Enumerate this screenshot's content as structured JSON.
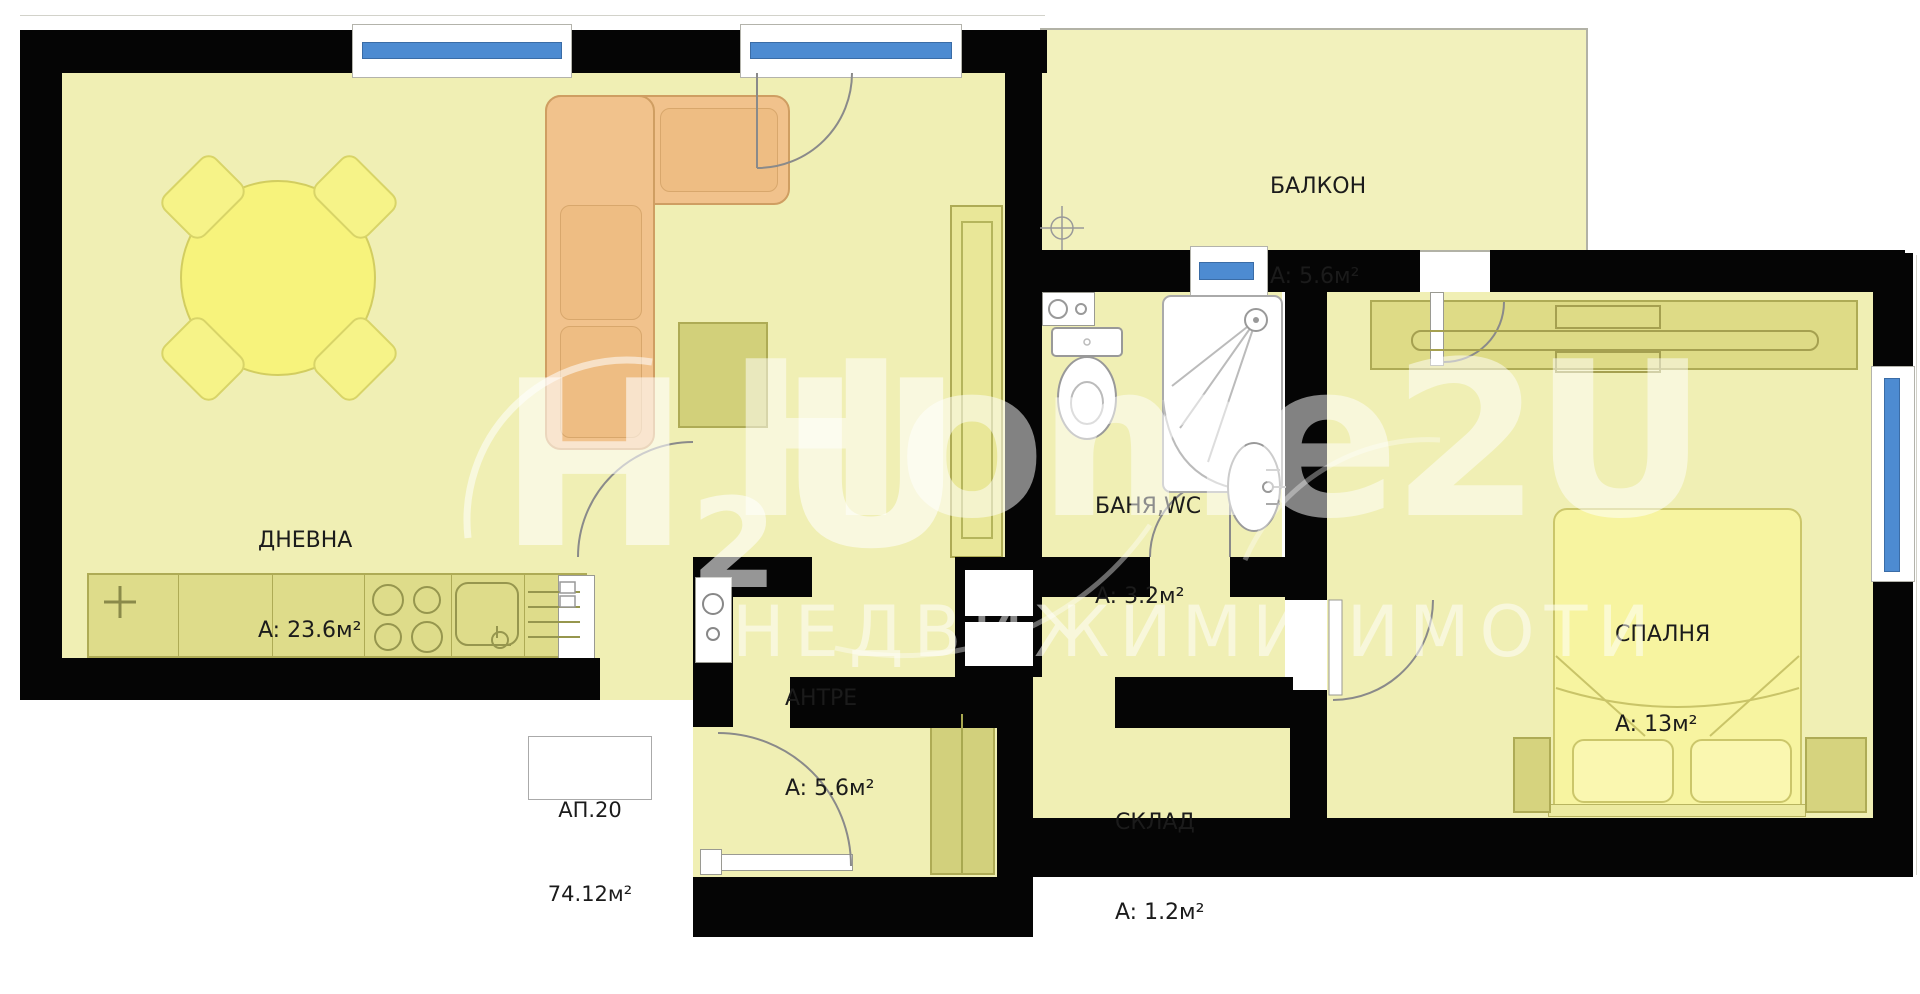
{
  "apartment": {
    "number": "АП.20",
    "total_area": "74.12м²"
  },
  "rooms": [
    {
      "name": "ДНЕВНА",
      "area": "A: 23.6м²"
    },
    {
      "name": "БАЛКОН",
      "area": "A: 5.6м²"
    },
    {
      "name": "БАНЯ,WC",
      "area": "A: 3.2м²"
    },
    {
      "name": "АНТРЕ",
      "area": "A: 5.6м²"
    },
    {
      "name": "СКЛАД",
      "area": "A: 1.2м²"
    },
    {
      "name": "СПАЛНЯ",
      "area": "A: 13м²"
    }
  ],
  "watermark": {
    "logo_h": "H",
    "logo_sub": "2",
    "logo_u": "U",
    "brand": "Home2U",
    "tagline": "НЕДВИЖИМИ ИМОТИ"
  },
  "colors": {
    "wall": "#050505",
    "floor": "#f0efb4",
    "furniture": "#dcda88",
    "sofa": "#f1c28c",
    "window_blue": "#4d8bd1",
    "label_text": "#1b1b1b"
  }
}
